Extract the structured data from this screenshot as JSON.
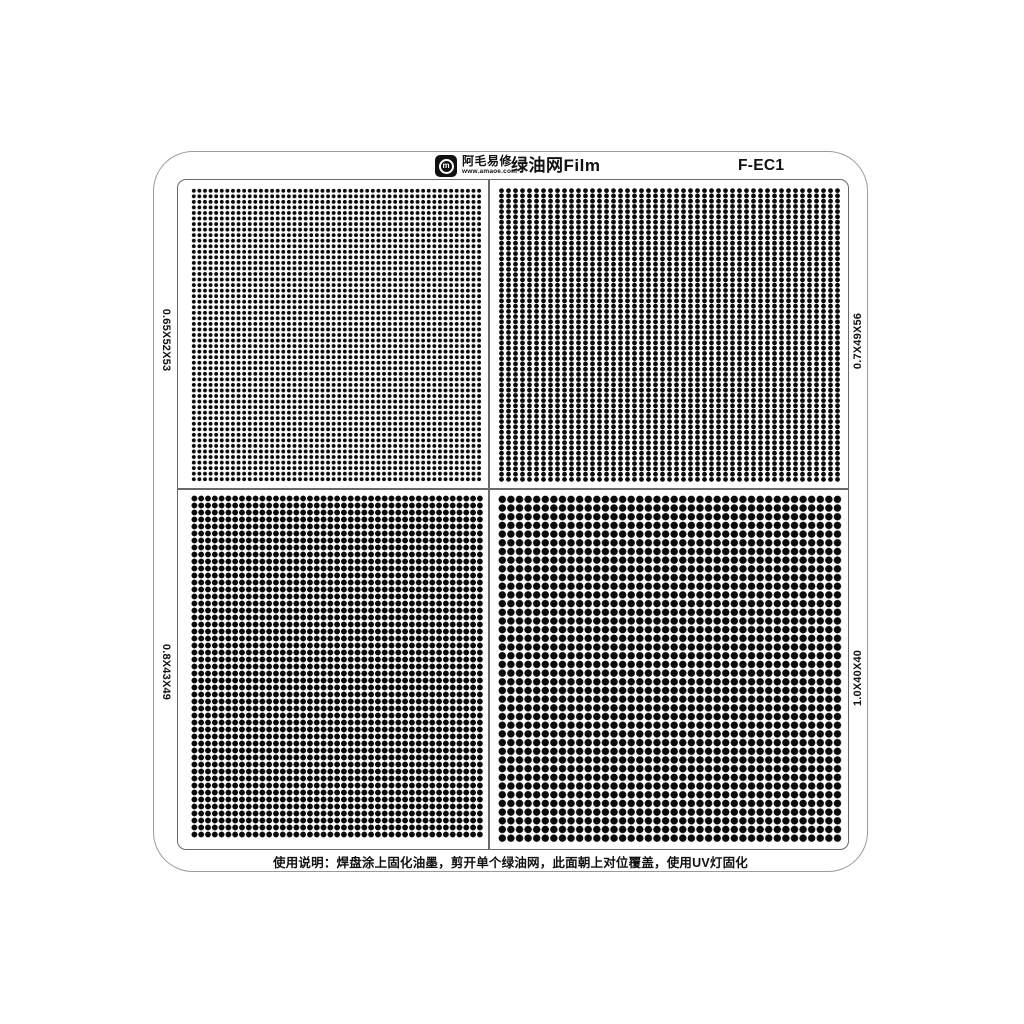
{
  "product": {
    "brand": "阿毛易修",
    "brand_url": "www.amaoe.com",
    "logo_glyph": "m",
    "title": "绿油网Film",
    "model": "F-EC1"
  },
  "quadrants": [
    {
      "id": "tl",
      "position": "top-left",
      "label": "0.65X52X53",
      "label_side": "left",
      "dot_size_mm": 0.65,
      "cols": 52,
      "rows": 53,
      "render": {
        "pitch_x": 5.6,
        "pitch_y": 5.55,
        "dot_d": 3.6
      }
    },
    {
      "id": "tr",
      "position": "top-right",
      "label": "0.7X49X56",
      "label_side": "right",
      "dot_size_mm": 0.7,
      "cols": 49,
      "rows": 56,
      "render": {
        "pitch_x": 7.0,
        "pitch_y": 5.25,
        "dot_d": 4.4
      }
    },
    {
      "id": "bl",
      "position": "bottom-left",
      "label": "0.8X43X49",
      "label_side": "left",
      "dot_size_mm": 0.8,
      "cols": 43,
      "rows": 49,
      "render": {
        "pitch_x": 6.8,
        "pitch_y": 7.0,
        "dot_d": 5.4
      }
    },
    {
      "id": "br",
      "position": "bottom-right",
      "label": "1.0X40X40",
      "label_side": "right",
      "dot_size_mm": 1.0,
      "cols": 40,
      "rows": 40,
      "render": {
        "pitch_x": 8.6,
        "pitch_y": 8.7,
        "dot_d": 7.0
      }
    }
  ],
  "footer": {
    "instruction": "使用说明：焊盘涂上固化油墨，剪开单个绿油网，此面朝上对位覆盖，使用UV灯固化"
  },
  "colors": {
    "dot": "#0a0a0a",
    "sheet_border": "#9b9b9b",
    "frame_border": "#6a6a6a",
    "text": "#111111",
    "background": "#ffffff"
  }
}
